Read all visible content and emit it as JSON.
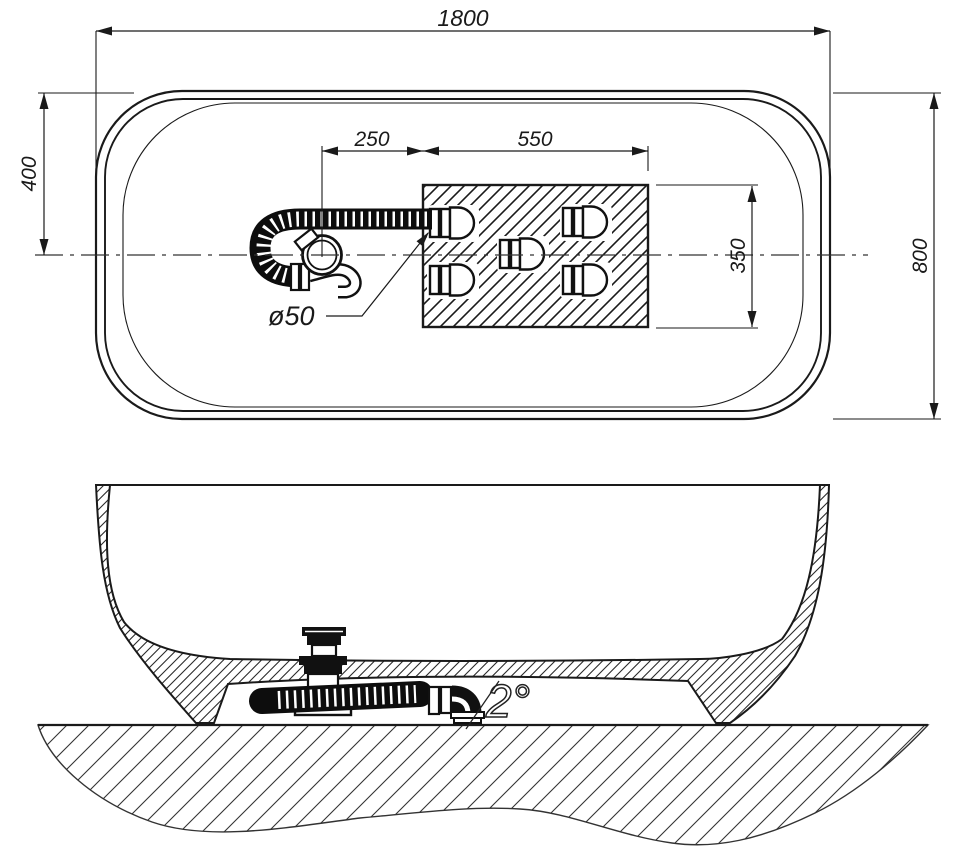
{
  "drawing": {
    "title": "bathtub installation drawing",
    "views": {
      "top": "plan view",
      "front": "section elevation"
    },
    "line_color": "#1a1a1a",
    "background_color": "#ffffff"
  },
  "labels": {
    "length_overall": "1800",
    "width_overall": "800",
    "drain_center_from_end": "400",
    "drain_to_deck": "250",
    "deck_length": "550",
    "deck_depth": "350",
    "drain_diameter": "ø50",
    "base_slope": "2°"
  }
}
